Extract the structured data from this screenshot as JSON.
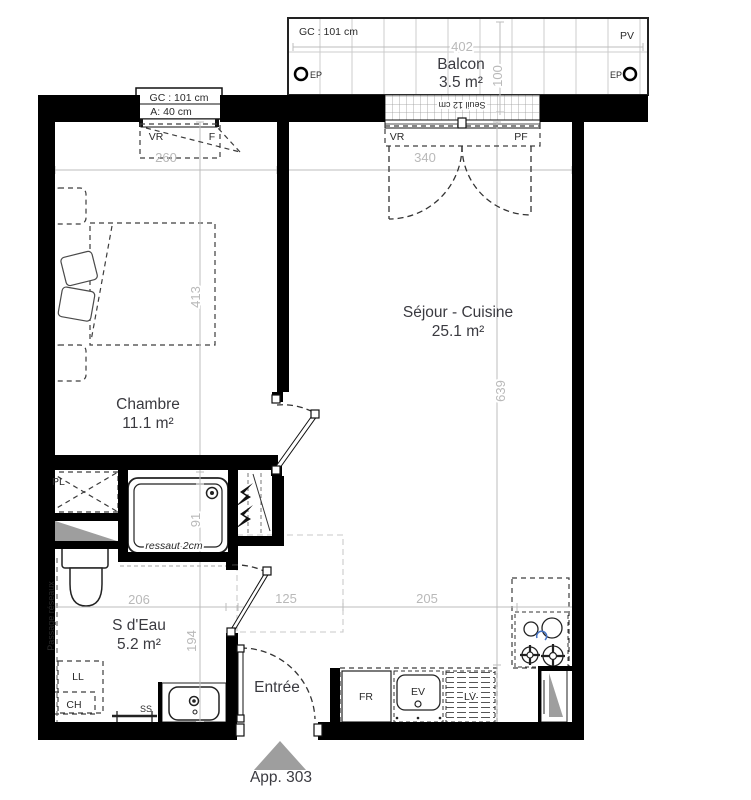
{
  "apartment": {
    "marker_label": "App. 303"
  },
  "rooms": {
    "chambre": {
      "name": "Chambre",
      "area": "11.1 m²"
    },
    "sejour": {
      "name": "Séjour - Cuisine",
      "area": "25.1 m²"
    },
    "sdeau": {
      "name": "S d'Eau",
      "area": "5.2 m²"
    },
    "balcon": {
      "name": "Balcon",
      "area": "3.5 m²"
    },
    "entree": {
      "name": "Entrée"
    }
  },
  "dimensions": {
    "balcon_width": "402",
    "balcon_depth": "100",
    "chambre_width": "260",
    "sejour_width": "340",
    "chambre_depth": "413",
    "sejour_depth": "639",
    "shower_depth": "91",
    "sdeau_width": "206",
    "sdeau_depth": "194",
    "entree_width": "125",
    "cuisine_width": "205"
  },
  "annotations": {
    "balcon_gc": "GC : 101 cm",
    "pv": "PV",
    "ep_left": "EP",
    "ep_right": "EP",
    "seuil": "Seuil 12 cm",
    "window_gc": "GC : 101 cm",
    "window_a": "A: 40 cm",
    "window_vr": "VR",
    "window_f": "F",
    "baydoor_vr": "VR",
    "baydoor_pf": "PF",
    "ressaut": "ressaut 2cm",
    "passage": "Passage réseaux",
    "pl": "PL",
    "ll": "LL",
    "ch": "CH",
    "ss": "SS",
    "fr": "FR",
    "ev": "EV",
    "lv": "LV"
  },
  "colors": {
    "wall": "#000000",
    "dimension": "#b9b9b9",
    "gray_fill": "#9e9e9e",
    "accent_blue": "#4472c4"
  }
}
